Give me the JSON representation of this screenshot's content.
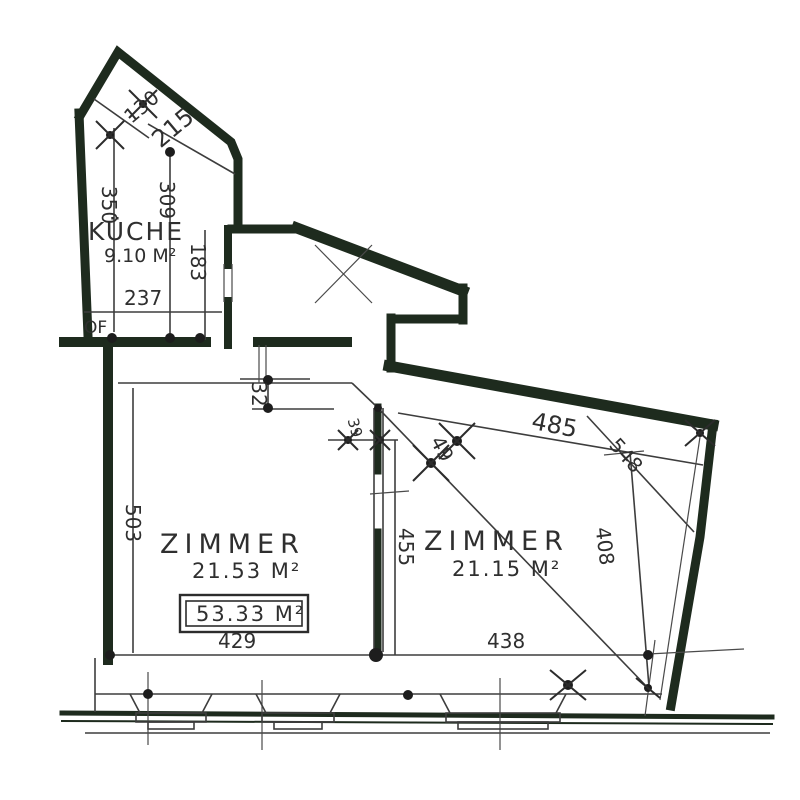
{
  "plan": {
    "kitchen": {
      "name": "KÜCHE",
      "area": "9.10 M²",
      "annotation": "OF",
      "dims": {
        "d130": "130",
        "d215": "215",
        "d350": "350",
        "d309": "309",
        "d237": "237",
        "d183": "183"
      }
    },
    "hall": {
      "dims": {
        "d32": "32",
        "d39": "39",
        "d49": "49"
      }
    },
    "room1": {
      "name": "ZIMMER",
      "area": "21.53 M²",
      "dims": {
        "d503": "503",
        "d429": "429"
      }
    },
    "room2": {
      "name": "ZIMMER",
      "area": "21.15 M²",
      "dims": {
        "d455": "455",
        "d485": "485",
        "d548": "548",
        "d408": "408",
        "d438": "438"
      }
    },
    "total_area": "53.33 M²"
  },
  "colors": {
    "wall": "#1e2b1e",
    "line": "#3d3d3d",
    "text": "#2f2f2f",
    "background": "#ffffff"
  }
}
